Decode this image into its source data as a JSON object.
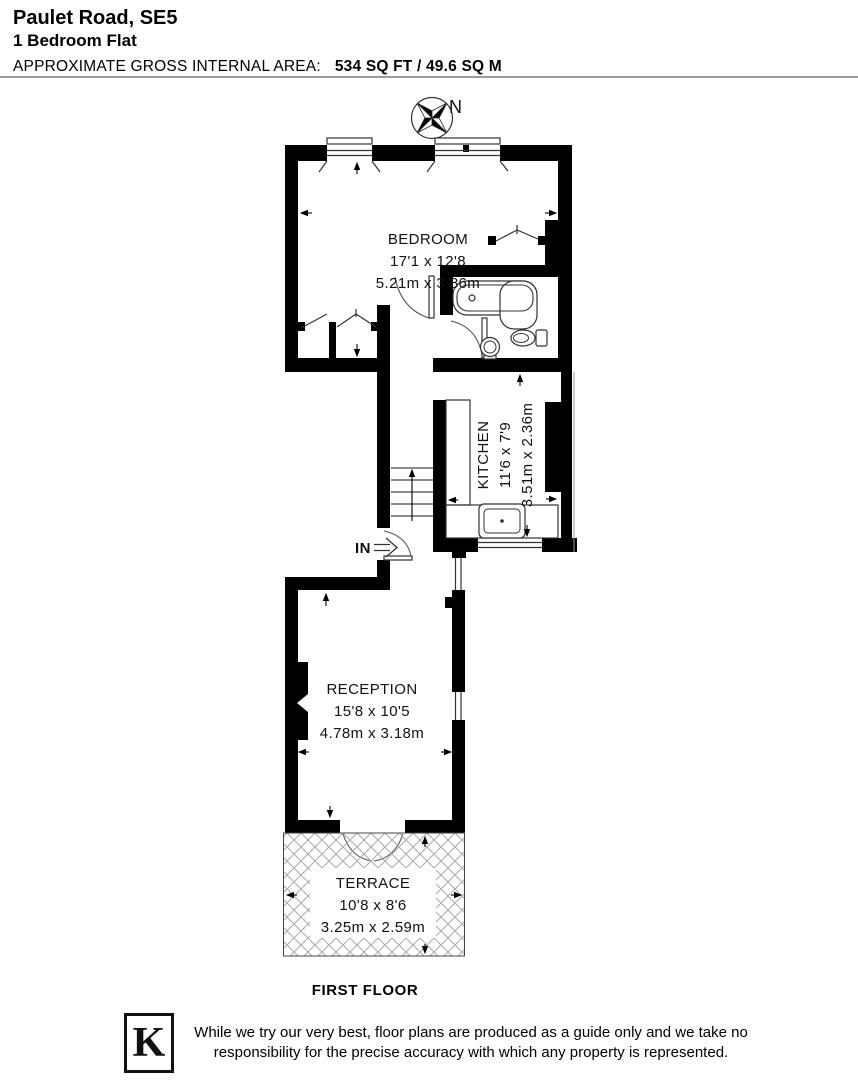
{
  "header": {
    "address": "Paulet Road, SE5",
    "property_type": "1 Bedroom Flat",
    "area_label": "APPROXIMATE GROSS INTERNAL AREA:",
    "area_value": "534 SQ FT / 49.6 SQ M"
  },
  "compass": {
    "north_label": "N"
  },
  "rooms": {
    "bedroom": {
      "name": "BEDROOM",
      "dims_imperial": "17'1 x 12'8",
      "dims_metric": "5.21m x 3.86m"
    },
    "kitchen": {
      "name": "KITCHEN",
      "dims_imperial": "11'6 x 7'9",
      "dims_metric": "3.51m x 2.36m"
    },
    "reception": {
      "name": "RECEPTION",
      "dims_imperial": "15'8 x 10'5",
      "dims_metric": "4.78m x 3.18m"
    },
    "terrace": {
      "name": "TERRACE",
      "dims_imperial": "10'8 x 8'6",
      "dims_metric": "3.25m x 2.59m"
    }
  },
  "entrance": {
    "label": "IN"
  },
  "floor_label": "FIRST FLOOR",
  "footer": {
    "logo_letter": "K",
    "disclaimer": "While we try our very best, floor plans are produced as a guide only and we take no responsibility for the precise accuracy with which any property is represented."
  }
}
